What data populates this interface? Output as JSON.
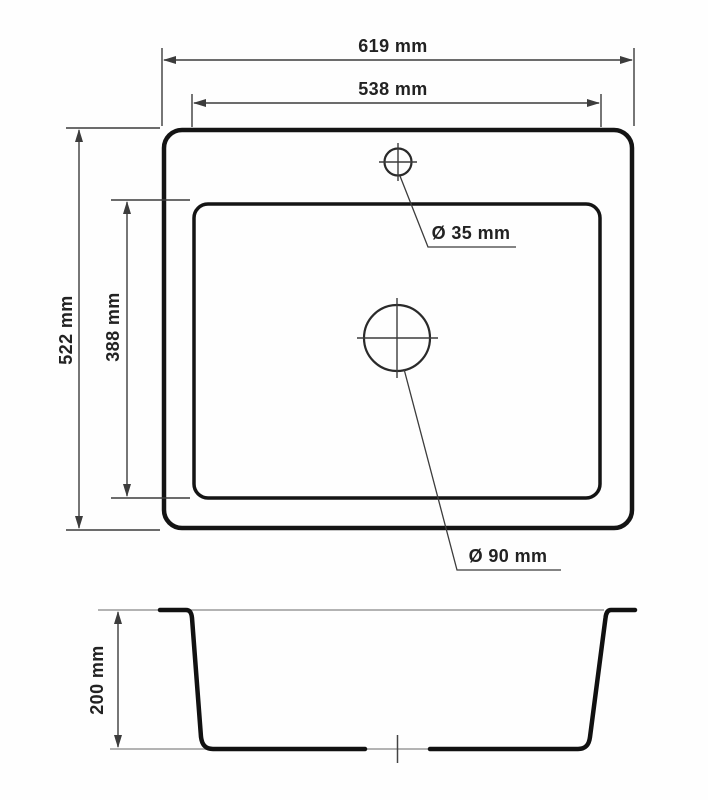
{
  "units": "mm",
  "colors": {
    "outline": "#141414",
    "dimension_line": "#3c3c3c",
    "light_line": "#9a9a9a",
    "text": "#222222",
    "background": "#ffffff"
  },
  "top_view": {
    "outer_width": {
      "label": "619 mm",
      "value": 619
    },
    "inner_width": {
      "label": "538 mm",
      "value": 538
    },
    "outer_height": {
      "label": "522 mm",
      "value": 522
    },
    "inner_height": {
      "label": "388 mm",
      "value": 388
    },
    "faucet_hole": {
      "label": "Ø 35 mm",
      "value": 35
    },
    "drain_hole": {
      "label": "Ø 90 mm",
      "value": 90
    }
  },
  "section_view": {
    "bowl_depth": {
      "label": "200 mm",
      "value": 200
    }
  }
}
